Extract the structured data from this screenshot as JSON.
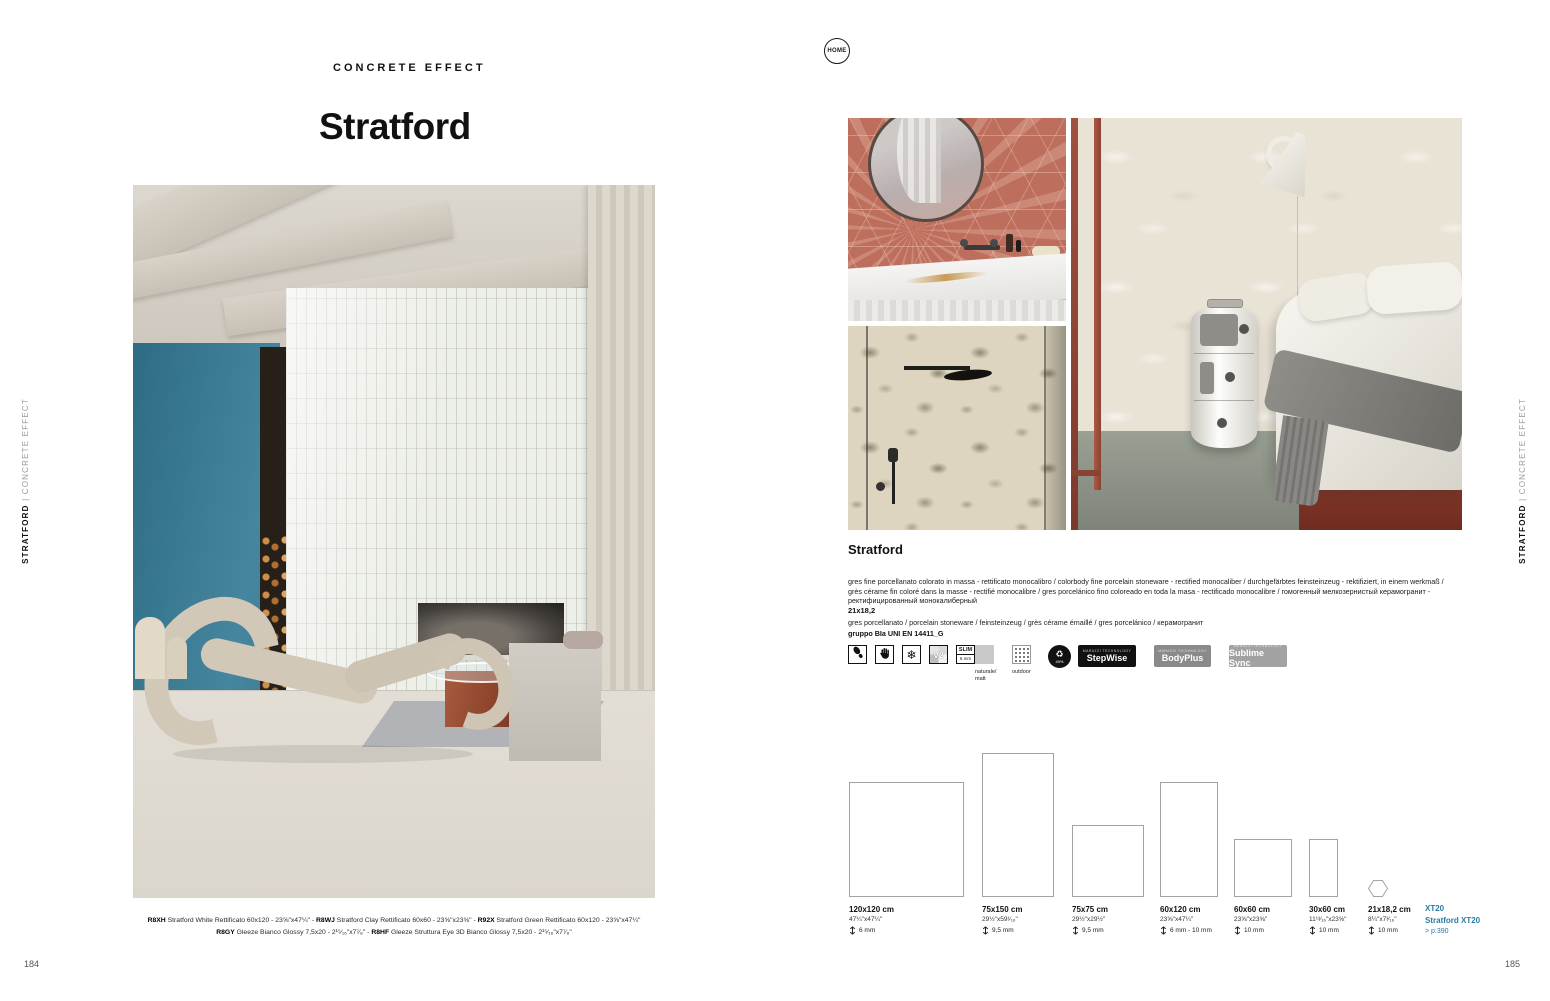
{
  "colors": {
    "accent_blue": "#2a7ca2",
    "terracotta_tile": "#bd6e5c",
    "teal_wall": "#37788f",
    "badge_black": "#111111",
    "badge_gray": "#8a8a8a",
    "badge_light_gray": "#a2a2a2"
  },
  "home_button": {
    "label": "HOME"
  },
  "left_page": {
    "eyebrow": "CONCRETE EFFECT",
    "title": "Stratford",
    "page_number": "184",
    "sidebar": {
      "bold": "STRATFORD",
      "divider": " | ",
      "light": "CONCRETE EFFECT"
    },
    "caption": {
      "separator": " - ",
      "lines": [
        [
          {
            "code": "R8XH",
            "text": "Stratford White Rettificato 60x120 - 23⅝\"x47¼\""
          },
          {
            "code": "R8WJ",
            "text": "Stratford Clay Rettificato 60x60 - 23⅝\"x23⅝\""
          },
          {
            "code": "R92X",
            "text": "Stratford Green Rettificato 60x120 - 23⅝\"x47¼\""
          }
        ],
        [
          {
            "code": "R8GY",
            "text": "Gleeze Bianco Glossy 7,5x20 - 2¹⁵⁄₁₆\"x7⁷⁄₈\""
          },
          {
            "code": "R8HF",
            "text": "Gleeze Struttura Eye 3D Bianco Glossy 7,5x20 - 2¹⁵⁄₁₆\"x7⁷⁄₈\""
          }
        ]
      ]
    }
  },
  "right_page": {
    "page_number": "185",
    "sidebar": {
      "bold": "STRATFORD",
      "divider": " | ",
      "light": "CONCRETE EFFECT"
    },
    "product": {
      "name": "Stratford",
      "description": "gres fine porcellanato colorato in massa - rettificato monocalibro / colorbody fine porcelain stoneware - rectified monocaliber / durchgefärbtes feinsteinzeug - rektifiziert, in einem werkmaß / grès cérame fin coloré dans la masse - rectifié monocalibre / gres porcelánico fino coloreado en toda la masa - rectificado monocalibre / гомогенный мелкозернистый керамогранит - ректифицированный монокалиберный",
      "size_note": "21x18,2",
      "material": "gres porcellanato / porcelain stoneware / feinsteinzeug / grès cérame émaillé / gres porcelánico / керамогранит",
      "group": "gruppo BIa UNI EN 14411_G"
    },
    "icons": {
      "v2_label": "V2",
      "slim_top": "SLIM",
      "slim_bottom": "6 mm",
      "finish_label_1": "naturale/",
      "finish_label_2": "matt",
      "outdoor_label": "outdoor",
      "recycle_symbol": "♻",
      "recycle_value": "40%",
      "badge_sub": "MARAZZI TECHNOLOGY",
      "stepwise": "StepWise",
      "bodyplus": "BodyPlus",
      "sublime_sync": "Sublime Sync"
    },
    "sizes": [
      {
        "label": "120x120 cm",
        "inches": "47¼\"x47¼\"",
        "thickness": "6 mm",
        "w_cm": 120,
        "h_cm": 120,
        "shape": "rect"
      },
      {
        "label": "75x150 cm",
        "inches": "29½\"x59¹⁄₁₆\"",
        "thickness": "9,5 mm",
        "w_cm": 75,
        "h_cm": 150,
        "shape": "rect"
      },
      {
        "label": "75x75 cm",
        "inches": "29½\"x29½\"",
        "thickness": "9,5 mm",
        "w_cm": 75,
        "h_cm": 75,
        "shape": "rect"
      },
      {
        "label": "60x120 cm",
        "inches": "23⅝\"x47¼\"",
        "thickness": "6 mm - 10 mm",
        "w_cm": 60,
        "h_cm": 120,
        "shape": "rect"
      },
      {
        "label": "60x60 cm",
        "inches": "23⅝\"x23⅝\"",
        "thickness": "10 mm",
        "w_cm": 60,
        "h_cm": 60,
        "shape": "rect"
      },
      {
        "label": "30x60 cm",
        "inches": "11¹³⁄₁₆\"x23⅝\"",
        "thickness": "10 mm",
        "w_cm": 30,
        "h_cm": 60,
        "shape": "rect"
      },
      {
        "label": "21x18,2 cm",
        "inches": "8¼\"x7³⁄₁₆\"",
        "thickness": "10 mm",
        "w_cm": 21,
        "h_cm": 18.2,
        "shape": "hexagon"
      }
    ],
    "xt20": {
      "line1": "XT20",
      "line2": "Stratford XT20",
      "line3": "> p.390"
    }
  }
}
